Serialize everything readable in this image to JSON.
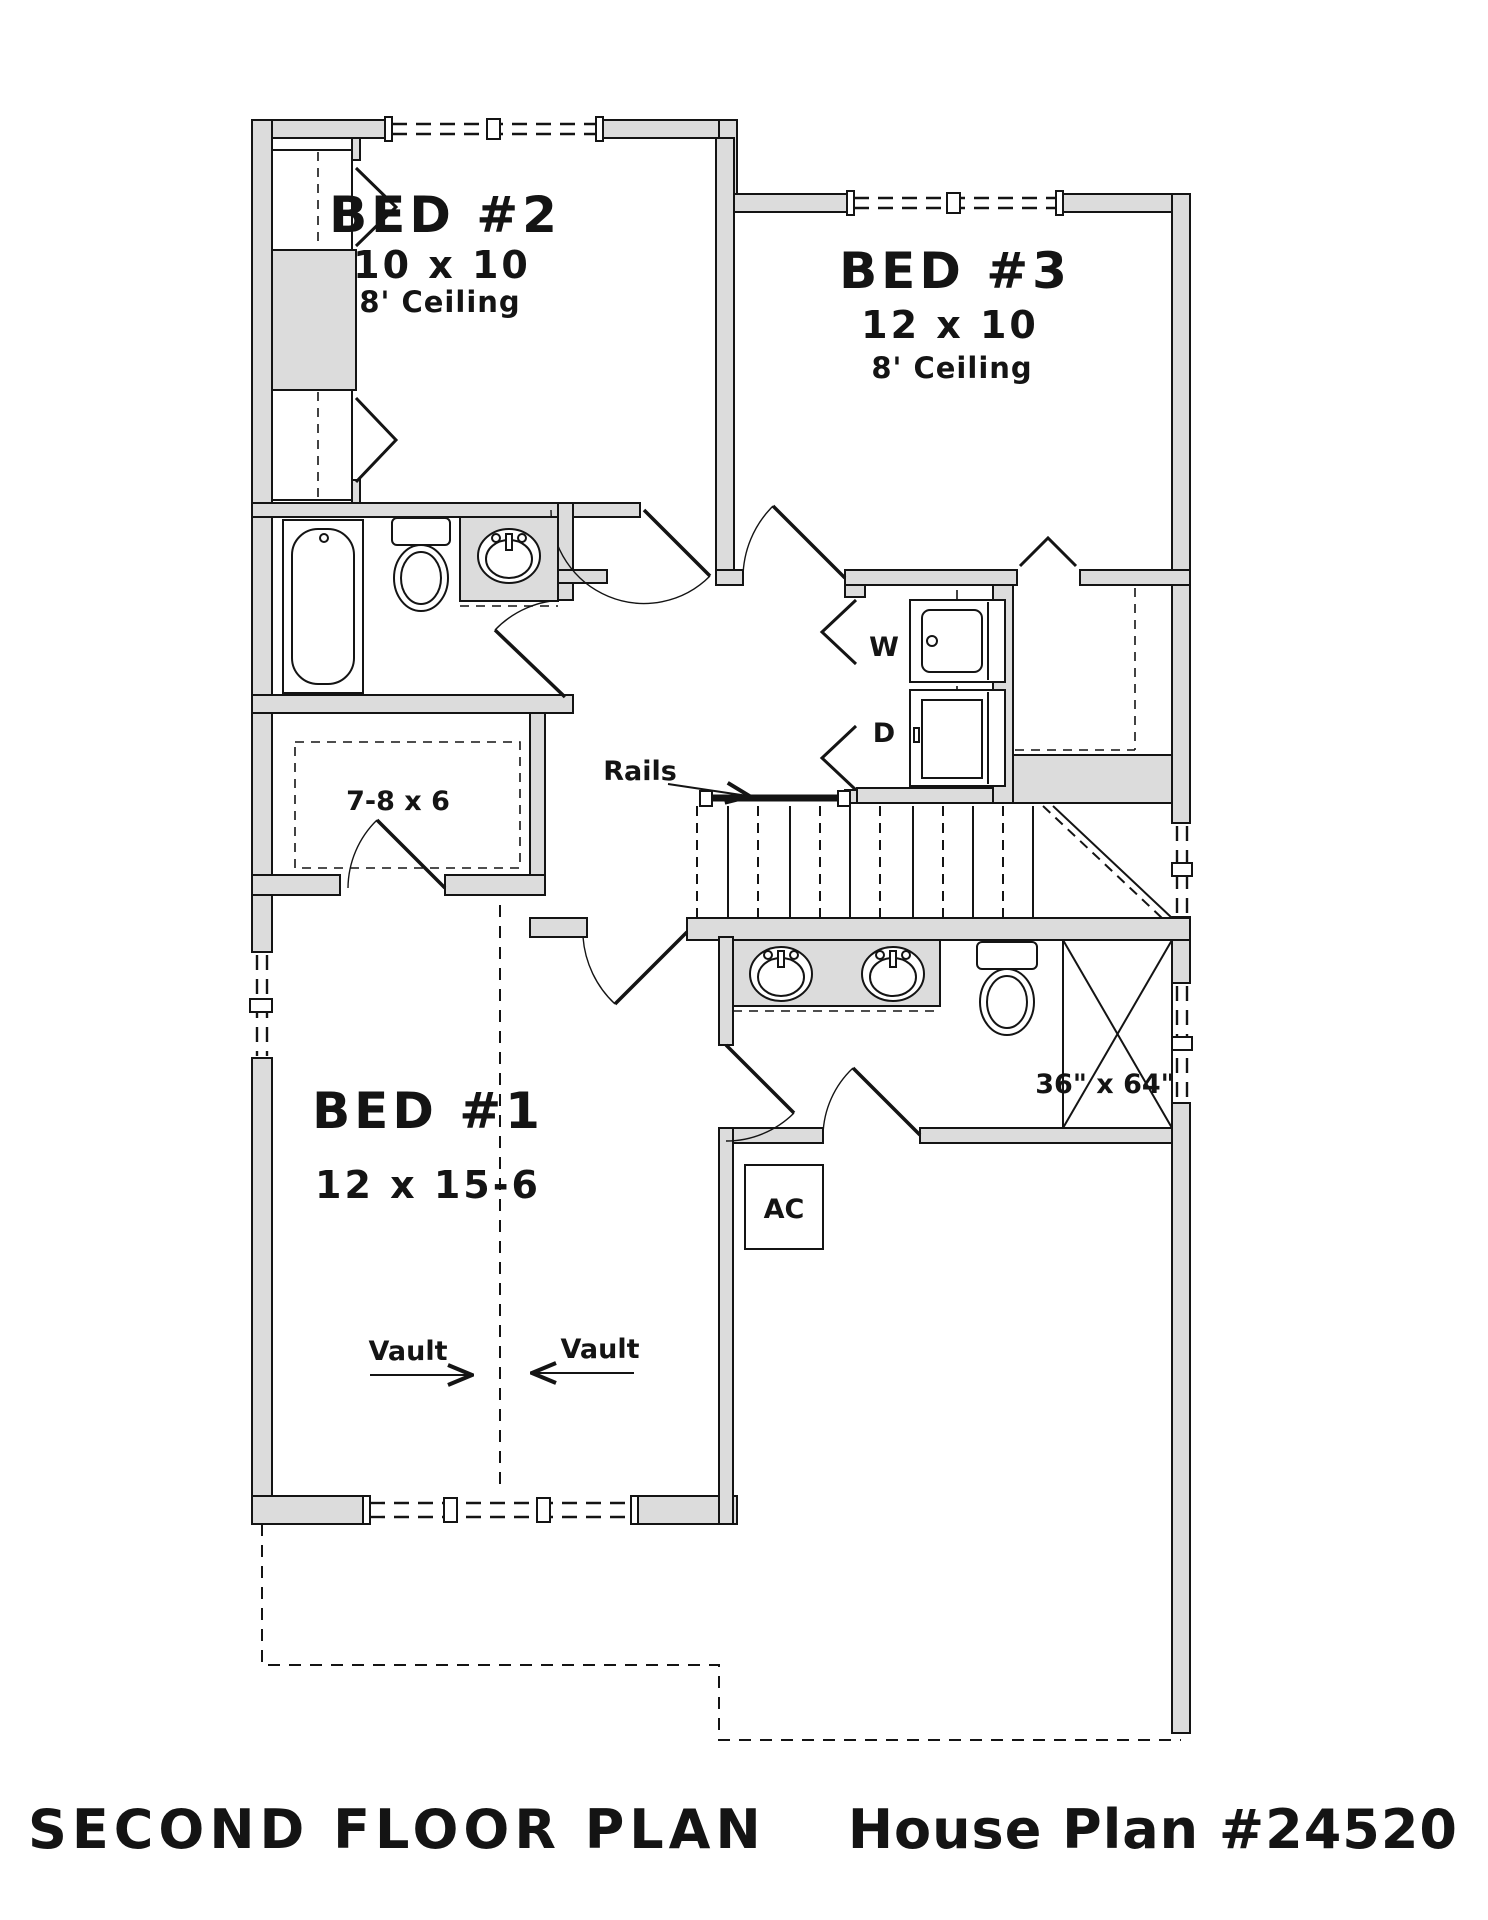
{
  "title": {
    "drawing": "SECOND FLOOR PLAN",
    "plan": "House Plan #24520"
  },
  "rooms": {
    "bed2": {
      "name": "BED #2",
      "dims": "10 x 10",
      "ceiling": "8' Ceiling"
    },
    "bed3": {
      "name": "BED #3",
      "dims": "12 x 10",
      "ceiling": "8' Ceiling"
    },
    "bed1": {
      "name": "BED #1",
      "dims": "12 x 15-6"
    },
    "walk_in_closet": {
      "dims": "7-8 x 6"
    }
  },
  "labels": {
    "rails": "Rails",
    "washer": "W",
    "dryer": "D",
    "ac": "AC",
    "shower_size": "36\" x 64\"",
    "vault_left": "Vault",
    "vault_right": "Vault"
  },
  "colors": {
    "wall_fill": "#dcdcdc",
    "line": "#141414",
    "background": "#ffffff"
  }
}
